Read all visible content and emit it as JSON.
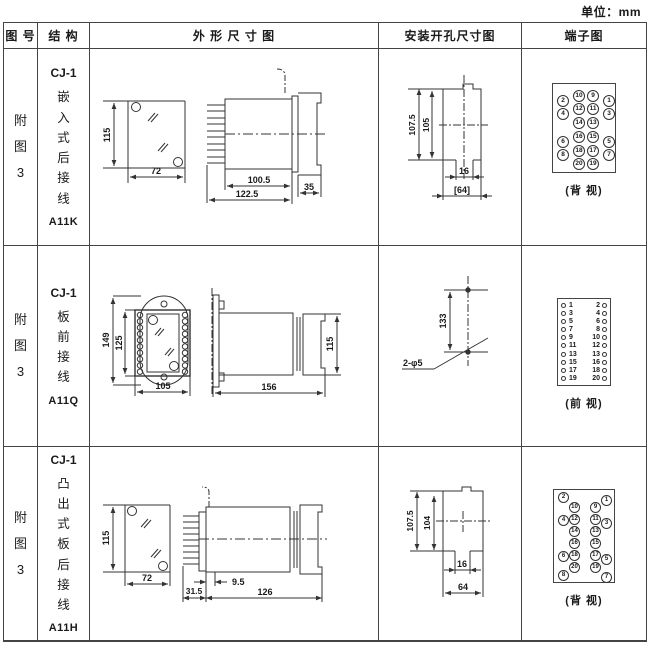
{
  "page": {
    "unit_label": "单位：mm"
  },
  "table": {
    "headers": [
      "图 号",
      "结 构",
      "外 形 尺 寸 图",
      "安装开孔尺寸图",
      "端子图"
    ]
  },
  "rows": [
    {
      "fig_no": "附图3",
      "model": "CJ-1",
      "mounting": "嵌入式后接线",
      "code": "A11K",
      "outline": {
        "front_h": "115",
        "front_w": "72",
        "d1": "100.5",
        "d2": "122.5",
        "d3": "35"
      },
      "install": {
        "v1": "107.5",
        "v2": "105",
        "h1": "16",
        "h2": "[64]"
      },
      "terminal": {
        "view": "(背 视)",
        "outer_left": [
          "2",
          "4",
          "6",
          "8"
        ],
        "mid_left": [
          "10",
          "12",
          "14",
          "16",
          "18",
          "20"
        ],
        "mid_right": [
          "9",
          "11",
          "13",
          "15",
          "17",
          "19"
        ],
        "outer_right": [
          "1",
          "3",
          "5",
          "7"
        ]
      }
    },
    {
      "fig_no": "附图3",
      "model": "CJ-1",
      "mounting": "板前接线",
      "code": "A11Q",
      "outline": {
        "front_h1": "149",
        "front_h2": "125",
        "front_w": "105",
        "side_l": "156",
        "side_h": "115"
      },
      "install": {
        "v1": "133",
        "label": "2-φ5"
      },
      "terminal": {
        "view": "(前 视)",
        "left": [
          "1",
          "3",
          "5",
          "7",
          "9",
          "11",
          "13",
          "15",
          "17",
          "19"
        ],
        "right": [
          "2",
          "4",
          "6",
          "8",
          "10",
          "12",
          "13",
          "16",
          "18",
          "20"
        ]
      }
    },
    {
      "fig_no": "附图3",
      "model": "CJ-1",
      "mounting": "凸出式板后接线",
      "code": "A11H",
      "outline": {
        "front_h": "115",
        "front_w": "72",
        "d1": "31.5",
        "d2": "9.5",
        "d3": "126"
      },
      "install": {
        "v1": "107.5",
        "v2": "104",
        "h1": "16",
        "h2": "64"
      },
      "terminal": {
        "view": "(背 视)",
        "outer_left": [
          "2",
          "4",
          "6",
          "8"
        ],
        "mid_left": [
          "10",
          "12",
          "14",
          "16",
          "18",
          "20"
        ],
        "mid_right": [
          "9",
          "11",
          "13",
          "15",
          "17",
          "19"
        ],
        "outer_right": [
          "1",
          "3",
          "5",
          "7"
        ]
      }
    }
  ]
}
